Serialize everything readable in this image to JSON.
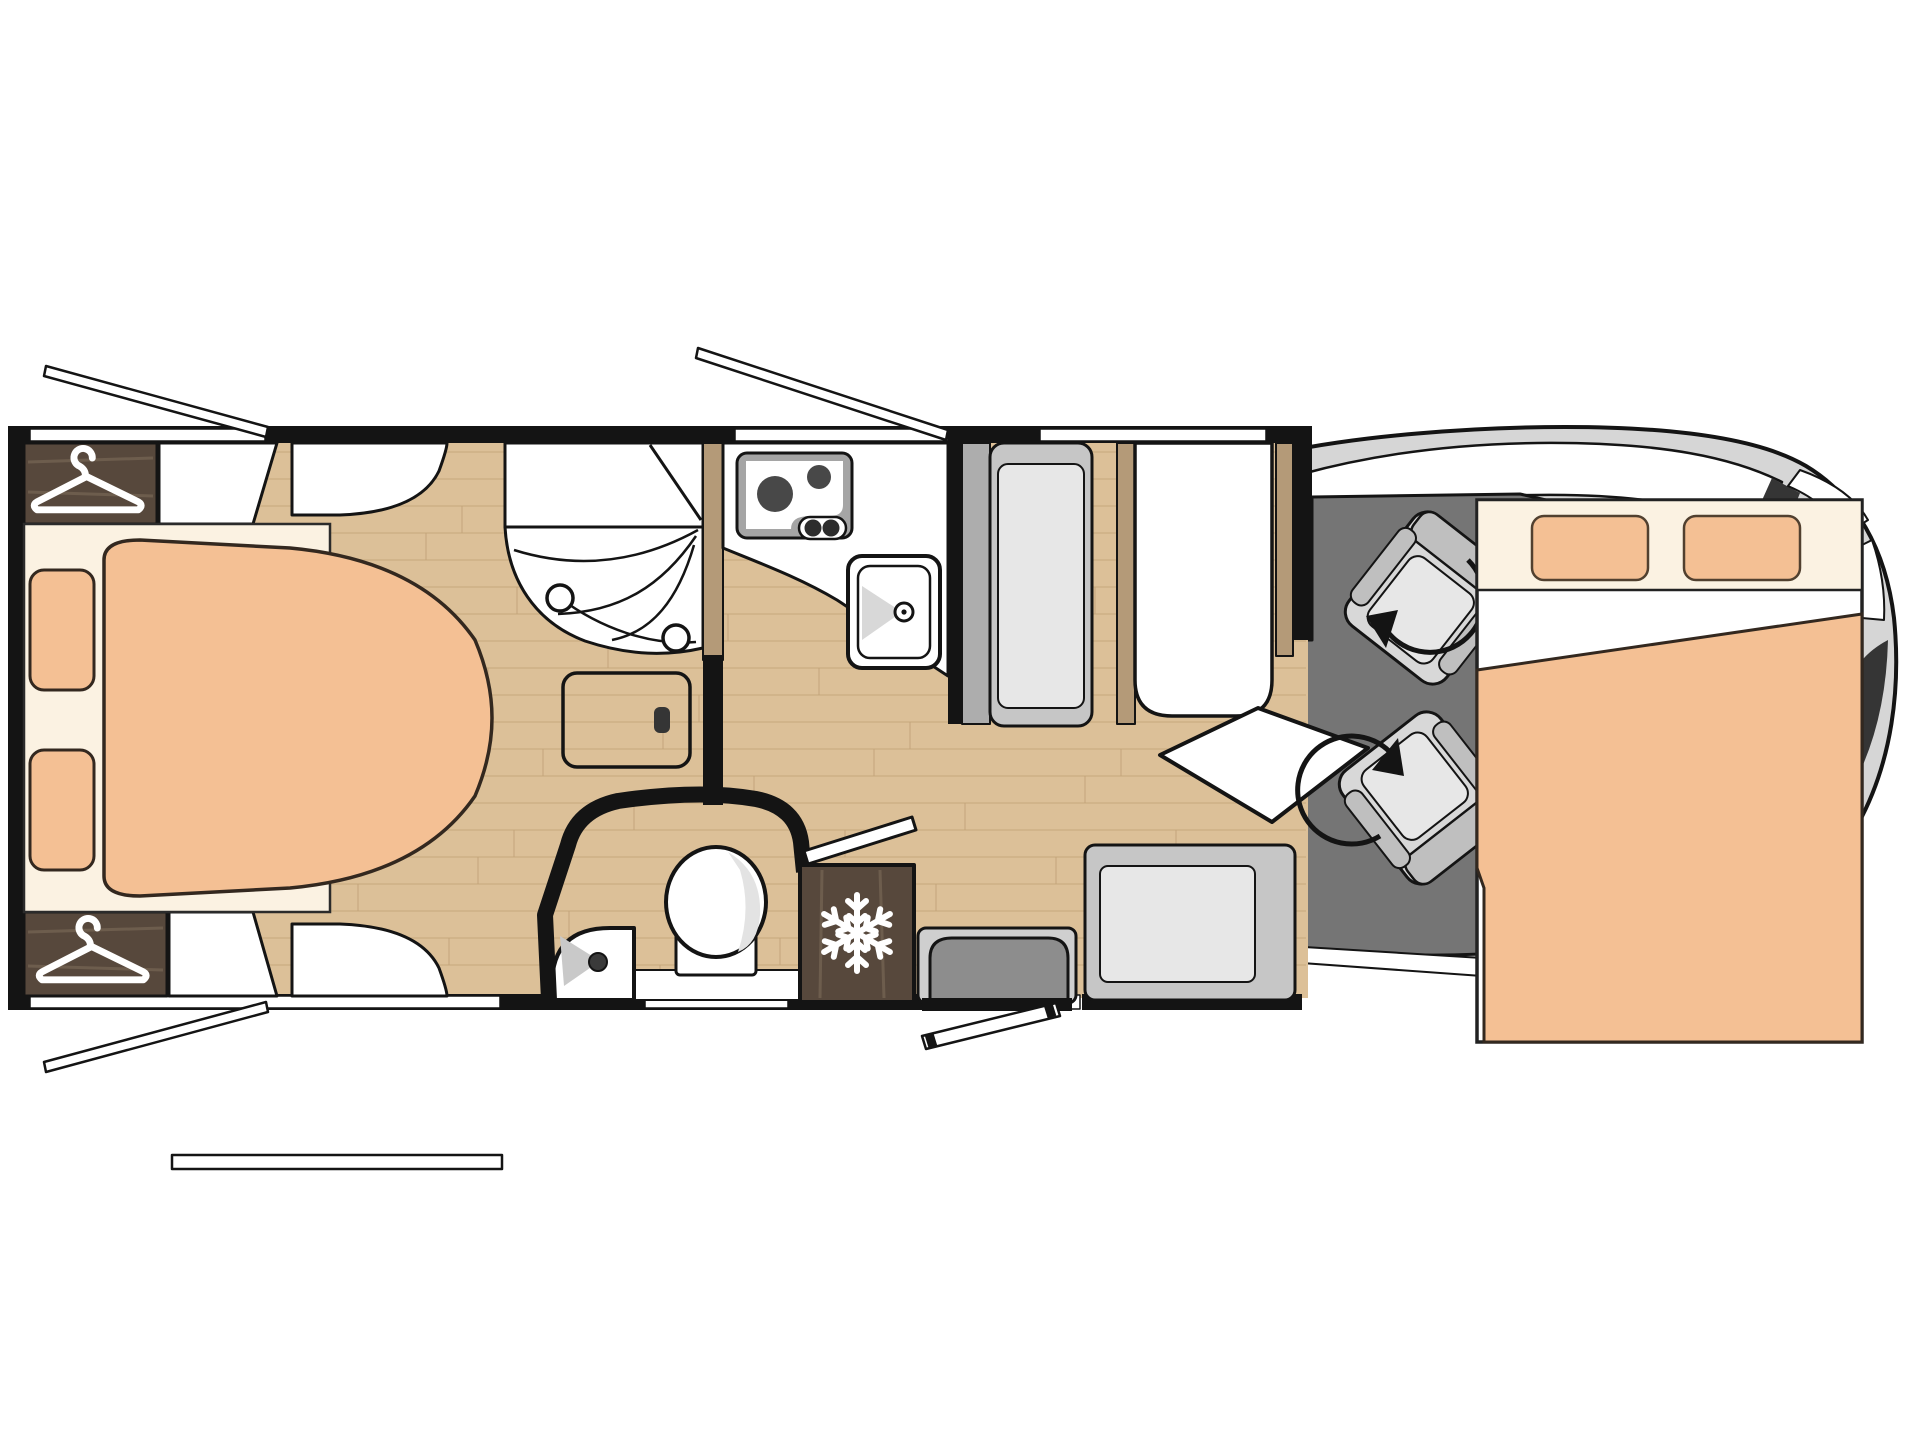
{
  "diagram": {
    "type": "floorplan",
    "subject": "motorhome-layout-top-view",
    "orientation": "cab-at-right",
    "regions": [
      "rear-bedroom",
      "shower-room",
      "washroom",
      "kitchen",
      "dinette",
      "entrance",
      "cab",
      "front-drop-down-bed"
    ]
  },
  "colors": {
    "wall": "#141414",
    "floor": "#dcc098",
    "floor_line": "#c2a379",
    "mattress": "#f4c094",
    "bed_base": "#fbf2e2",
    "dark_wood": "#57483c",
    "dark_wood_streak": "#7d6b59",
    "wood_panel": "#b49a78",
    "cab_floor": "#757575",
    "body_gray": "#d6d6d6",
    "seat_light": "#d8d8d8",
    "seat_mid": "#bfbfbf",
    "cushion": "#e7e7e7",
    "bench_frame": "#c6c6c6",
    "bench_back": "#adadad",
    "step_dark": "#8d8d8d",
    "hob_frame": "#a5a5a5",
    "burner": "#484848",
    "dark_accent": "#353535"
  },
  "icons": {
    "wardrobe_top": "hanger-icon",
    "wardrobe_bottom": "hanger-icon",
    "fridge": "snowflake-icon",
    "driver_seat": "swivel-arrow-icon",
    "passenger_seat": "swivel-arrow-icon"
  },
  "furniture": {
    "rear_bed": "island-bed-with-two-pillows",
    "front_bed": "drop-down-bed-with-two-pillows",
    "hob": "two-burner-hob",
    "sink": "kitchen-sink",
    "shower": "corner-shower-with-curtain",
    "toilet": "toilet",
    "washbasin": "corner-washbasin",
    "table": "dinette-table-with-swivel-extension",
    "bench_dinette": "l-shaped-bench",
    "bench_front": "forward-facing-bench",
    "step": "entrance-step",
    "fridge": "refrigerator",
    "open_doors": [
      "entry-door-open",
      "washroom-door-open"
    ],
    "open_window_flaps": 4
  }
}
